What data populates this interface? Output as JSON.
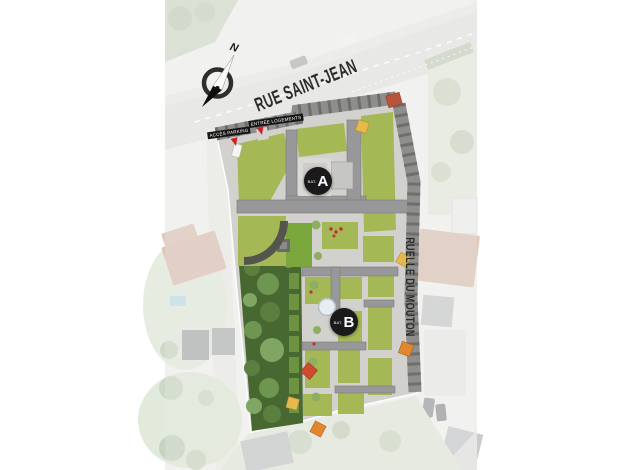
{
  "map": {
    "compass": {
      "north_label": "N"
    },
    "streets": [
      {
        "name": "RUE SAINT-JEAN"
      },
      {
        "name": "RUELLE DU MOUTON"
      }
    ],
    "access_labels": [
      {
        "text": "ACCÈS PARKING"
      },
      {
        "text": "ENTRÉE LOGEMENTS"
      }
    ],
    "building_markers": [
      {
        "prefix": "BAT.",
        "letter": "A"
      },
      {
        "prefix": "BAT.",
        "letter": "B"
      }
    ],
    "colors": {
      "marker_background": "#1a1a1a",
      "street_text": "#2c2c2c",
      "entrance_arrow_red": "#cf2127",
      "green_roof": "#a4b955",
      "bright_lawn": "#79a73c",
      "garden_green": "#486831",
      "roof_gray": "#8e8e8c",
      "parasol_orange": "#e0872f",
      "parasol_yellow": "#e6b94d"
    }
  }
}
